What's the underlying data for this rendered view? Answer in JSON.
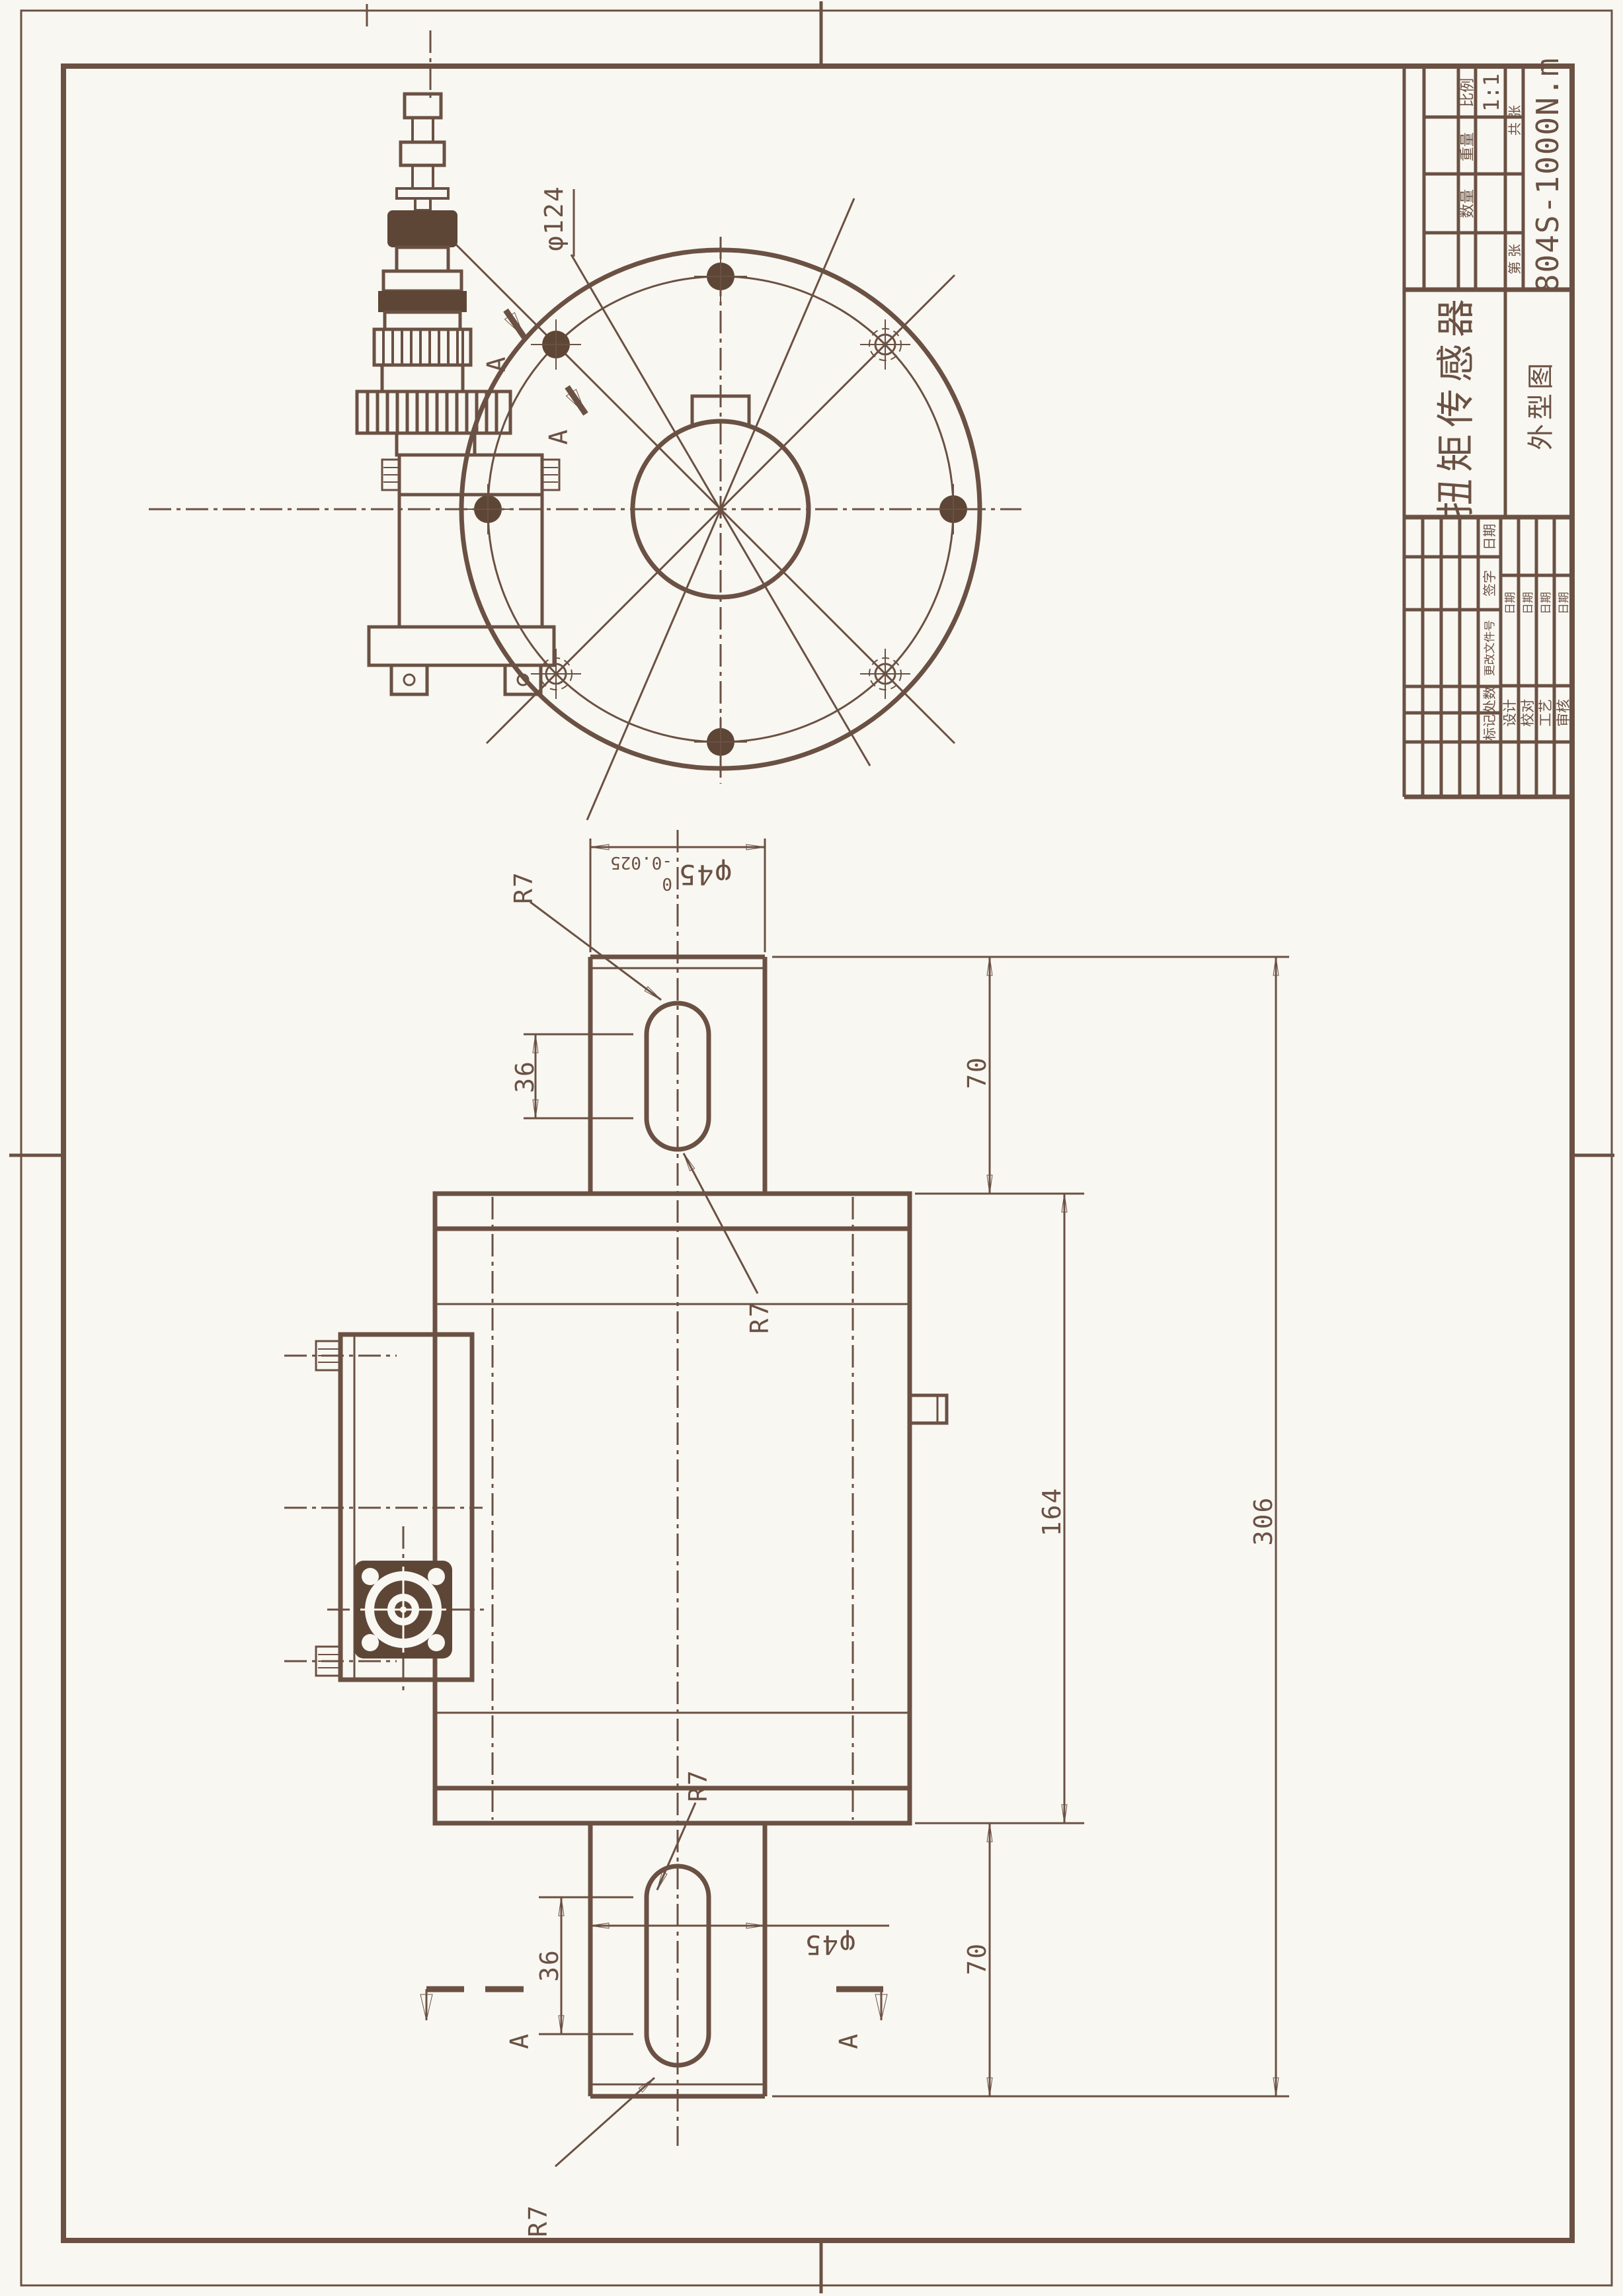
{
  "page": {
    "background": "#f9f7f2",
    "ink": "#6a5143",
    "ink_dark": "#5e4636"
  },
  "title_block": {
    "product_name": "扭矩传感器",
    "view_name": "外型图",
    "part_number": "804S-1000N.m",
    "scale_label": "比例",
    "scale_value": "1:1",
    "weight_label": "重量",
    "quantity_label": "数量",
    "sheet_total_label": "共 张",
    "sheet_no_label": "第 张",
    "rev_fields": [
      "标记",
      "处数",
      "更改文件号",
      "签字",
      "日期"
    ],
    "sign_roles": [
      "设计",
      "校对",
      "工艺",
      "审核"
    ],
    "date_label": "日期"
  },
  "dimensions": {
    "bolt_circle_dia": "φ124",
    "shaft_dia": "φ45",
    "shaft_dia_tol_upper": "0",
    "shaft_dia_tol_lower": "-0.025",
    "shaft_dia_bottom": "φ45",
    "keyway_length": "36",
    "shaft_length": "70",
    "body_length": "164",
    "total_length": "306",
    "keyway_end_radius": "R7",
    "section_label": "A"
  }
}
